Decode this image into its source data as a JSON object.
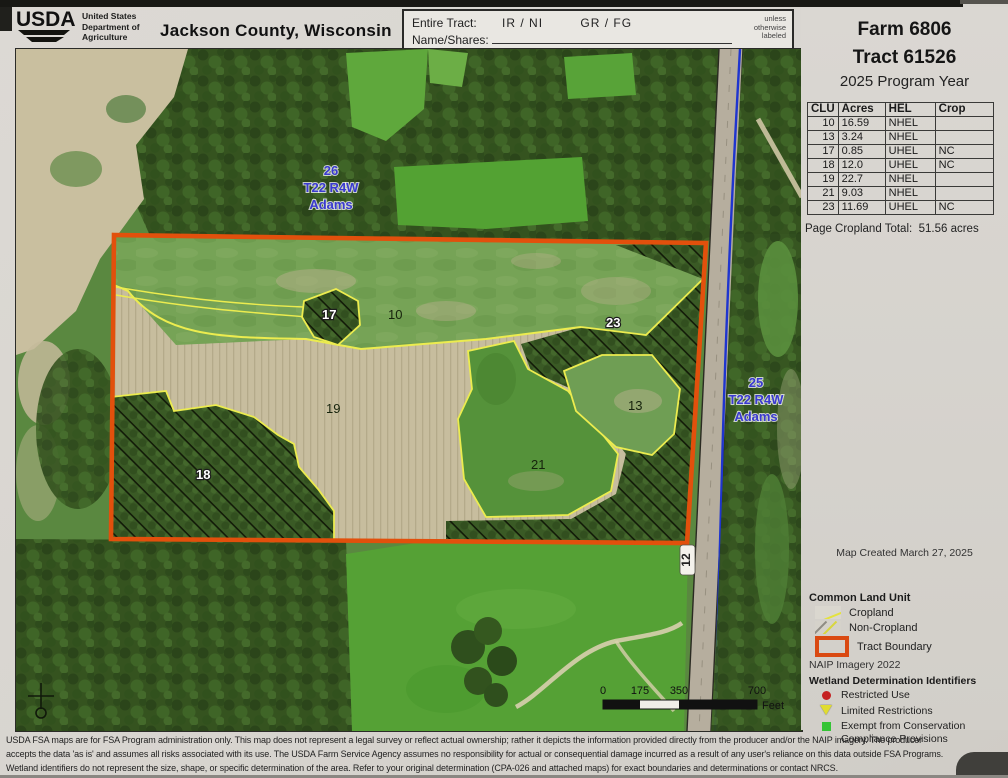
{
  "header": {
    "usda_acronym": "USDA",
    "dept_lines": [
      "United States",
      "Department of",
      "Agriculture"
    ],
    "title": "Jackson County, Wisconsin",
    "tract_box": {
      "entire_tract_label": "Entire Tract:",
      "code_pair_1": "IR / NI",
      "code_pair_2": "GR / FG",
      "name_shares_label": "Name/Shares:",
      "note_lines": [
        "unless",
        "otherwise",
        "labeled"
      ]
    }
  },
  "sidebar": {
    "farm": "Farm 6806",
    "tract": "Tract 61526",
    "program_year": "2025 Program Year",
    "clu_table": {
      "headers": [
        "CLU",
        "Acres",
        "HEL",
        "Crop"
      ],
      "rows": [
        [
          "10",
          "16.59",
          "NHEL",
          ""
        ],
        [
          "13",
          "3.24",
          "NHEL",
          ""
        ],
        [
          "17",
          "0.85",
          "UHEL",
          "NC"
        ],
        [
          "18",
          "12.0",
          "UHEL",
          "NC"
        ],
        [
          "19",
          "22.7",
          "NHEL",
          ""
        ],
        [
          "21",
          "9.03",
          "NHEL",
          ""
        ],
        [
          "23",
          "11.69",
          "UHEL",
          "NC"
        ]
      ]
    },
    "cropland_total_label": "Page Cropland Total:",
    "cropland_total_value": "51.56 acres",
    "map_created": "Map Created March 27, 2025",
    "legend": {
      "clu_title": "Common Land Unit",
      "cropland": "Cropland",
      "non_cropland": "Non-Cropland",
      "tract_boundary": "Tract Boundary",
      "naip": "NAIP Imagery 2022",
      "wetland_title": "Wetland Determination Identifiers",
      "restricted": "Restricted Use",
      "limited": "Limited Restrictions",
      "exempt_line1": "Exempt from Conservation",
      "exempt_line2": "Compliance Provisions"
    }
  },
  "map": {
    "section_label_26": {
      "lines": [
        "26",
        "T22 R4W",
        "Adams"
      ]
    },
    "section_label_25": {
      "lines": [
        "25",
        "T22 R4W",
        "Adams"
      ]
    },
    "field_labels": [
      {
        "id": "10"
      },
      {
        "id": "17"
      },
      {
        "id": "23"
      },
      {
        "id": "19"
      },
      {
        "id": "18"
      },
      {
        "id": "21"
      },
      {
        "id": "13"
      }
    ],
    "road_label": "12",
    "scale_bar": {
      "ticks": [
        "0",
        "175",
        "350",
        "700"
      ],
      "unit": "Feet"
    }
  },
  "footer": {
    "line1": "USDA FSA maps are for FSA Program administration only.  This map does not represent a legal survey or reflect actual ownership; rather it depicts the information provided directly from the producer and/or the NAIP imagery.  The producer",
    "line2": "accepts the data 'as is' and assumes all risks associated with its use.  The USDA Farm Service Agency assumes no responsibility for actual or consequential damage incurred as a result of any user's reliance on this data outside FSA Programs.",
    "line3": "Wetland identifiers do not represent the size, shape, or specific determination of the area.  Refer to your original determination (CPA-026 and attached maps) for exact boundaries and determinations or contact NRCS."
  },
  "colors": {
    "tract_boundary": "#e2500c",
    "cropland_line": "#ecec4f",
    "water": "#2233cc",
    "section_label_blue": "#3a3ad0",
    "restricted_red": "#c52222",
    "limited_yellow": "#e0dc30",
    "exempt_green": "#35c435"
  }
}
